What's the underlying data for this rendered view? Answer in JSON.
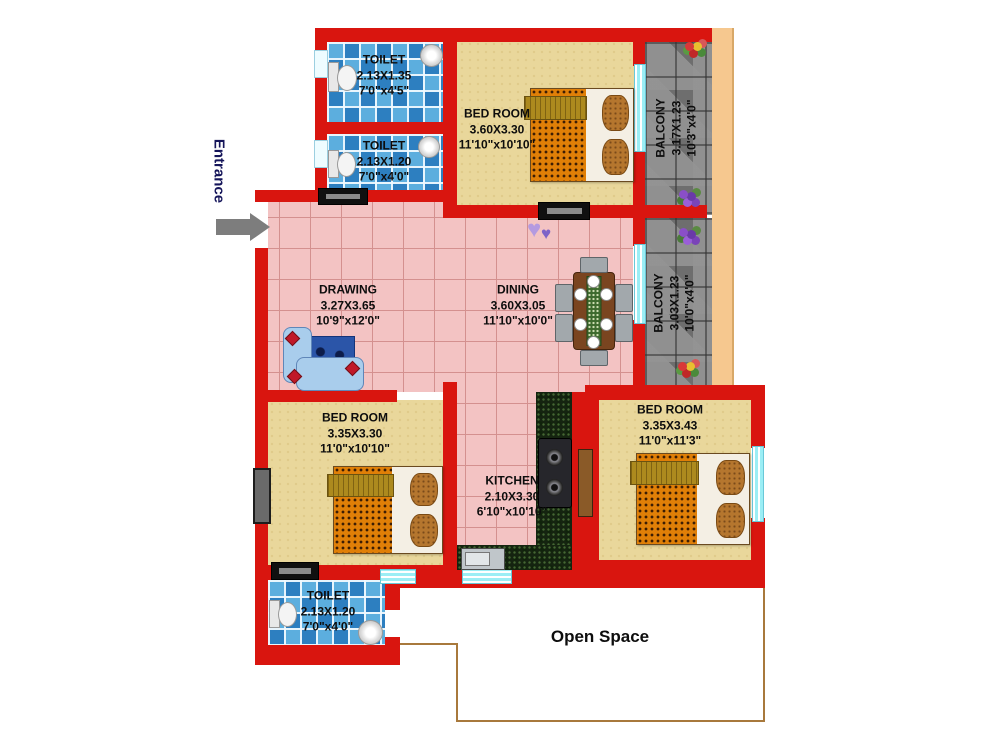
{
  "entrance": {
    "label": "Entrance"
  },
  "open_space": {
    "label": "Open Space"
  },
  "rooms": {
    "toilet_top": {
      "name": "TOILET",
      "metric": "2.13X1.35",
      "imperial": "7'0\"x4'5\""
    },
    "toilet_mid": {
      "name": "TOILET",
      "metric": "2.13X1.20",
      "imperial": "7'0\"x4'0\""
    },
    "bedroom_top": {
      "name": "BED ROOM",
      "metric": "3.60X3.30",
      "imperial": "11'10\"x10'10\""
    },
    "balcony_top": {
      "name": "BALCONY",
      "metric": "3.17X1.23",
      "imperial": "10'3\"x4'0\""
    },
    "drawing": {
      "name": "DRAWING",
      "metric": "3.27X3.65",
      "imperial": "10'9\"x12'0\""
    },
    "dining": {
      "name": "DINING",
      "metric": "3.60X3.05",
      "imperial": "11'10\"x10'0\""
    },
    "balcony_mid": {
      "name": "BALCONY",
      "metric": "3.03X1.23",
      "imperial": "10'0\"x4'0\""
    },
    "bedroom_left": {
      "name": "BED ROOM",
      "metric": "3.35X3.30",
      "imperial": "11'0\"x10'10\""
    },
    "kitchen": {
      "name": "KITCHEN",
      "metric": "2.10X3.30",
      "imperial": "6'10\"x10'10\""
    },
    "bedroom_right": {
      "name": "BED ROOM",
      "metric": "3.35X3.43",
      "imperial": "11'0\"x11'3\""
    },
    "toilet_bottom": {
      "name": "TOILET",
      "metric": "2.13X1.20",
      "imperial": "7'0\"x4'0\""
    }
  },
  "colors": {
    "wall": "#d9150f",
    "floor_pink": "#f3c3c3",
    "floor_pink_line": "#d4908f",
    "floor_cream": "#e9d79b",
    "tile_dark": "#2d7fc0",
    "tile_light": "#9fd2ea",
    "balcony_gray": "#909090",
    "outer_strip": "#f6c88f",
    "window_cyan": "#9beef5",
    "open_space_border": "#a8793c",
    "entrance_text": "#15155a",
    "arrow_gray": "#7d7d7d",
    "label_text": "#0d0d0d"
  }
}
